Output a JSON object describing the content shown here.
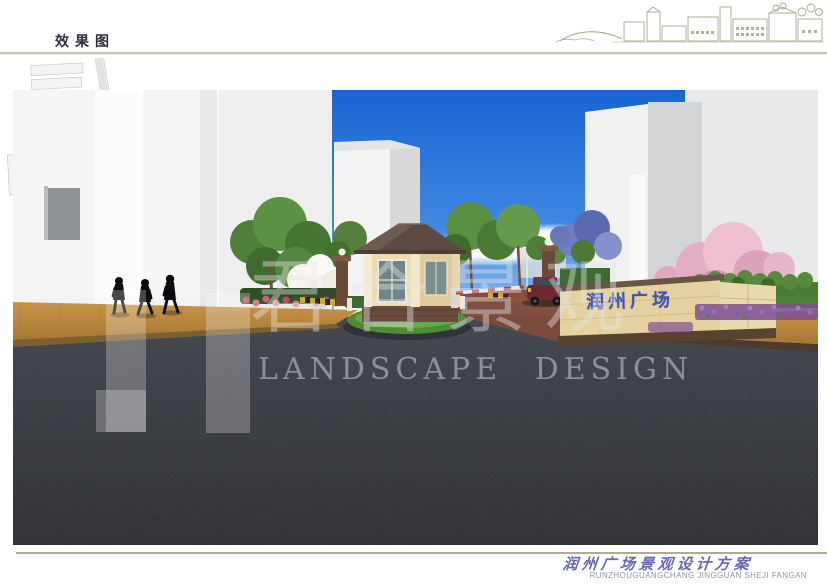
{
  "header": {
    "title": "效果图"
  },
  "site_plan": {
    "marker": "location-dot",
    "marker_color": "#b5323e"
  },
  "scene": {
    "entrance_sign_text": "润州广场",
    "sign_text_color": "#3d55b5"
  },
  "watermark": {
    "logo_cn": "君合景观",
    "logo_en": "LANDSCAPE DESIGN"
  },
  "footer": {
    "project_title": "润州广场景观设计方案",
    "project_subtitle": "RUNZHOUGUANGCHANG JINGGUAN SHEJI FANGAN"
  },
  "colors": {
    "sky_top": "#1a64d2",
    "sky_horizon": "#cfe3f5",
    "road": "#35373c",
    "walkway_wood": "#c08a3e",
    "guardhouse_roof": "#5d4b43",
    "sign_wall_beige": "#e6d2a0",
    "footer_line_tan": "#b3ab92",
    "title_color": "#30303f",
    "calligraphy_color": "#6b69ae"
  }
}
